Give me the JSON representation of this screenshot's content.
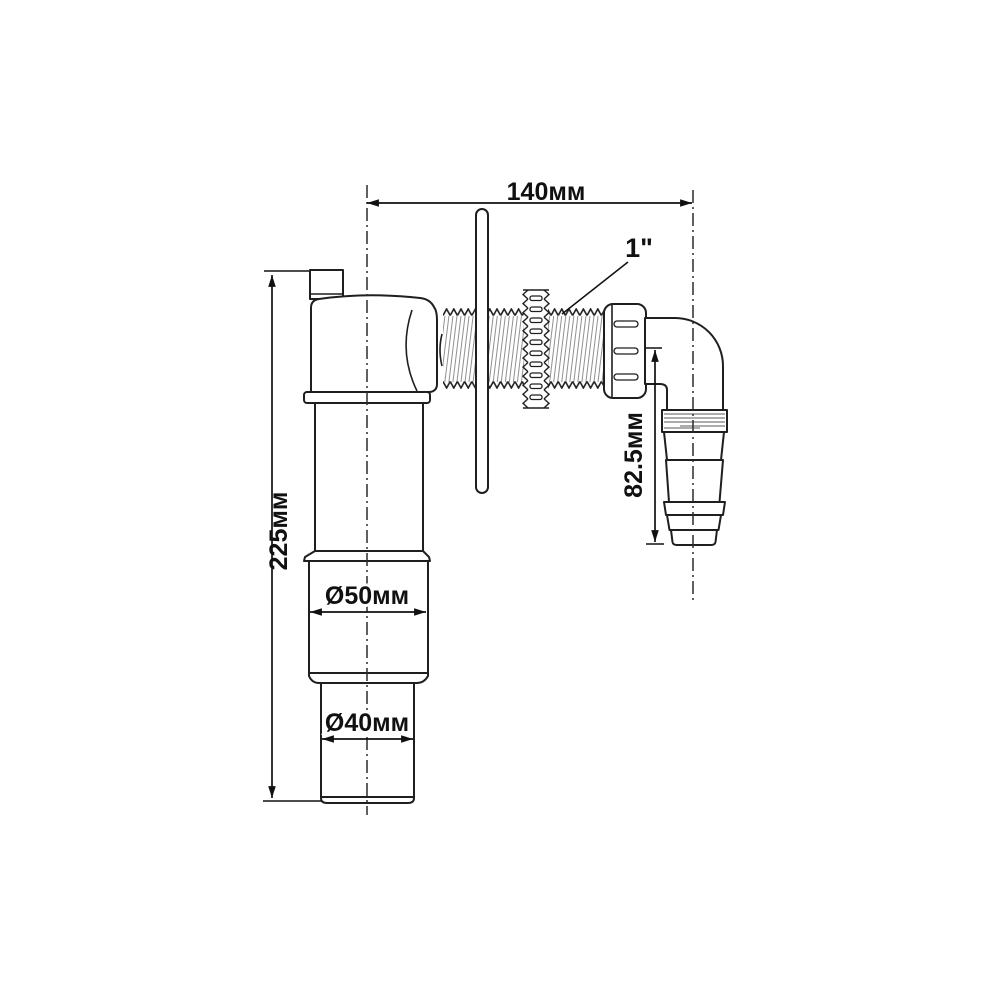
{
  "diagram": {
    "description": "Technical dimension drawing of a wall-mounted washing machine drain trap with elbow hose outlet",
    "labels": {
      "top_width": "140мм",
      "thread_size": "1\"",
      "overall_height": "225мм",
      "outlet_height": "82.5мм",
      "middle_diameter": "Ø50мм",
      "bottom_diameter": "Ø40мм"
    },
    "colors": {
      "background": "#ffffff",
      "outline": "#1f1f1f",
      "dimension": "#111111",
      "thread_hatch": "#909090"
    }
  }
}
